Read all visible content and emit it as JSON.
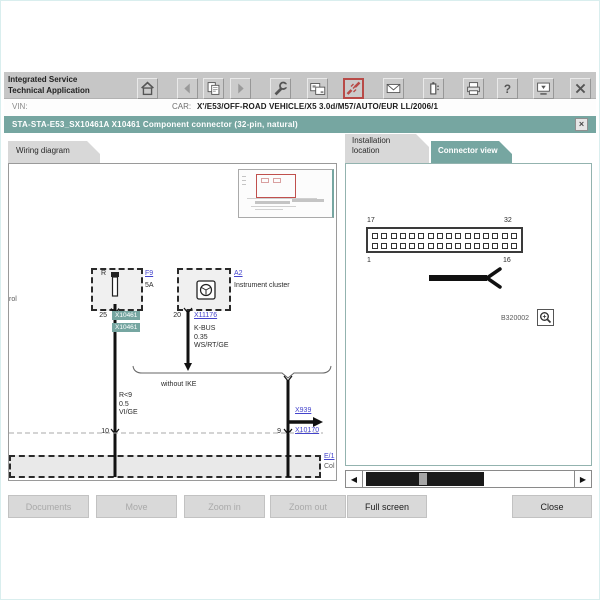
{
  "colors": {
    "accent_teal": "#76a6a1",
    "link_blue": "#4444cc",
    "alert_red": "#b84a47",
    "toolbar_gray": "#c6c6c6"
  },
  "toolbar": {
    "app_title_line1": "Integrated Service",
    "app_title_line2": "Technical Application",
    "help_glyph": "?",
    "icons": [
      "home",
      "back",
      "copy-document",
      "forward",
      "wrench",
      "dual-screens",
      "connector-plug",
      "mail-envelope",
      "battery",
      "printer",
      "help",
      "screen-tray",
      "close"
    ]
  },
  "vin_bar": {
    "vin_label": "VIN:",
    "car_label": "CAR:",
    "car_value": "X'/E53/OFF-ROAD VEHICLE/X5 3.0d/M57/AUTO/EUR LL/2006/1"
  },
  "dialog": {
    "title": "STA-STA-E53_SX10461A X10461 Component connector (32-pin, natural)",
    "close_glyph": "×"
  },
  "wiring": {
    "tab_label": "Wiring diagram",
    "edge_fragment": "rol",
    "fuse_designator": "R",
    "fuse_link": "F9",
    "fuse_rating": "5A",
    "fuse_pin": "25",
    "connector_label_1": "X10461",
    "connector_label_2": "X10461",
    "cluster_link": "A2",
    "cluster_name": "Instrument cluster",
    "cluster_pin": "20",
    "cluster_connector_link": "X11176",
    "bus_name": "K-BUS",
    "bus_gauge": "0.35",
    "bus_color": "WS/RT/GE",
    "variant_note": "without IKE",
    "wire_name": "R<9",
    "wire_gauge": "0.5",
    "wire_color": "VI/GE",
    "junction_pin_left": "10",
    "junction_pin_right": "9",
    "offpage_link": "X939",
    "junction_connector_link": "X10170",
    "bottom_link": "E/1",
    "bottom_fragment": "Col"
  },
  "connector_view": {
    "tab_installation_line1": "Installation",
    "tab_installation_line2": "location",
    "tab_connector": "Connector view",
    "pins_per_row": 16,
    "pin_top_left": "17",
    "pin_top_right": "32",
    "pin_bottom_left": "1",
    "pin_bottom_right": "16",
    "image_ref": "B320002",
    "scroll_left_glyph": "◀",
    "scroll_right_glyph": "▶"
  },
  "footer": {
    "documents": "Documents",
    "move": "Move",
    "zoom_in": "Zoom in",
    "zoom_out": "Zoom out",
    "full_screen": "Full screen",
    "close": "Close"
  }
}
